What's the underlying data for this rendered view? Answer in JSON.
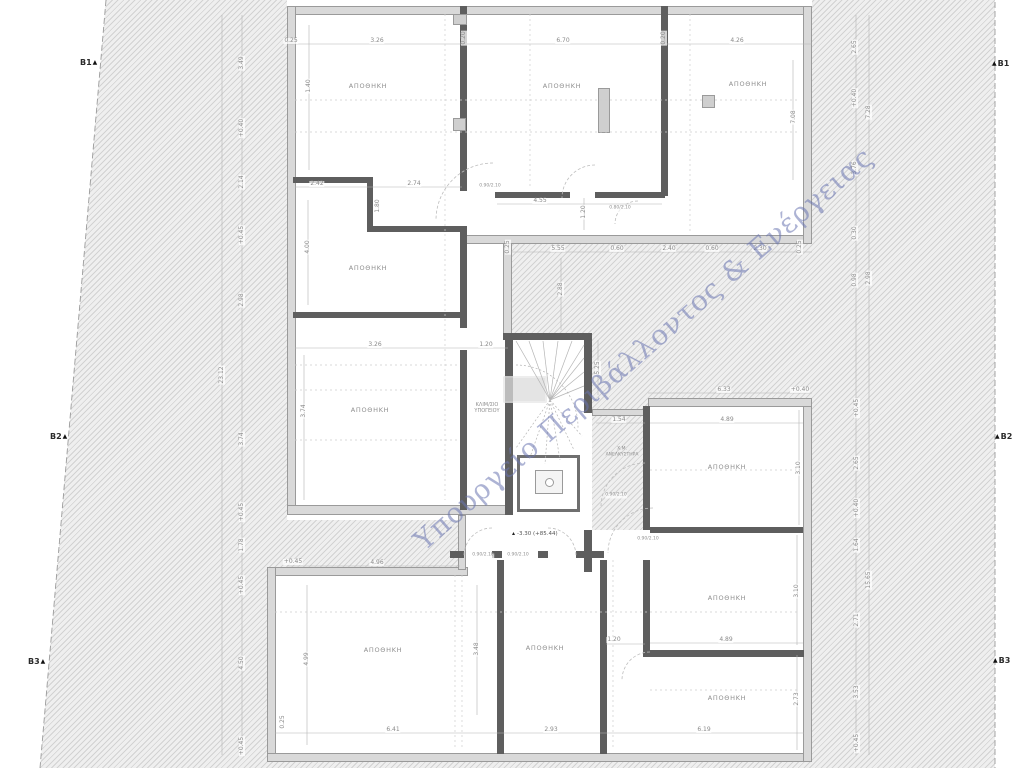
{
  "watermark": "Υπουργείο Περιβάλλοντος & Ενέργειας",
  "level_mark": "-3.30 (+85.44)",
  "markers": {
    "b1": "B1",
    "b2": "B2",
    "b3": "B3",
    "triangle": "▲"
  },
  "labels": {
    "storage": "ΑΠΟΘΗΚΗ",
    "stairwell_line1": "ΚΛΙΜ/ΣΙΟ",
    "stairwell_line2": "ΥΠΟΓΕΙΟΥ",
    "elevator_line1": "Χ.Μ.",
    "elevator_line2": "ΑΝΕΛΚΥΣΤΗΡΑ"
  },
  "dims": {
    "top": [
      "0.25",
      "3.26",
      "0.20",
      "6.70",
      "0.20",
      "4.26"
    ],
    "courtyard": [
      "0.25",
      "5.55",
      "0.60",
      "2.40",
      "0.60",
      "2.30",
      "0.25",
      "2.88",
      "5.25",
      "1.54",
      "6.33",
      "+0.40"
    ],
    "upper": [
      "1.40",
      "2.42",
      "1.80",
      "2.74",
      "4.55",
      "1.20",
      "7.08",
      "4.00",
      "3.26",
      "1.20",
      "3.74"
    ],
    "lower": [
      "+0.45",
      "4.96",
      "6.41",
      "4.99",
      "0.25",
      "2.93",
      "3.48",
      "1.20",
      "6.19"
    ],
    "right_rooms": [
      "4.89",
      "3.10",
      "4.89",
      "3.10",
      "2.73"
    ],
    "left_chain": [
      "3.49",
      "+0.40",
      "2.14",
      "+0.45",
      "2.98",
      "3.74",
      "+0.45",
      "1.78",
      "+0.45",
      "4.50",
      "+0.45",
      "23.12"
    ],
    "right_chain": [
      "2.65",
      "+0.40",
      "3.76",
      "0.30",
      "0.98",
      "+0.45",
      "2.65",
      "+0.40",
      "1.64",
      "2.71",
      "3.53",
      "+0.45",
      "7.28",
      "2.98",
      "15.65"
    ],
    "door_tags": [
      "0.90/2.10",
      "0.80/2.10",
      "0.90/2.10",
      "0.90/2.10",
      "0.90/2.10",
      "0.90/2.10"
    ]
  }
}
